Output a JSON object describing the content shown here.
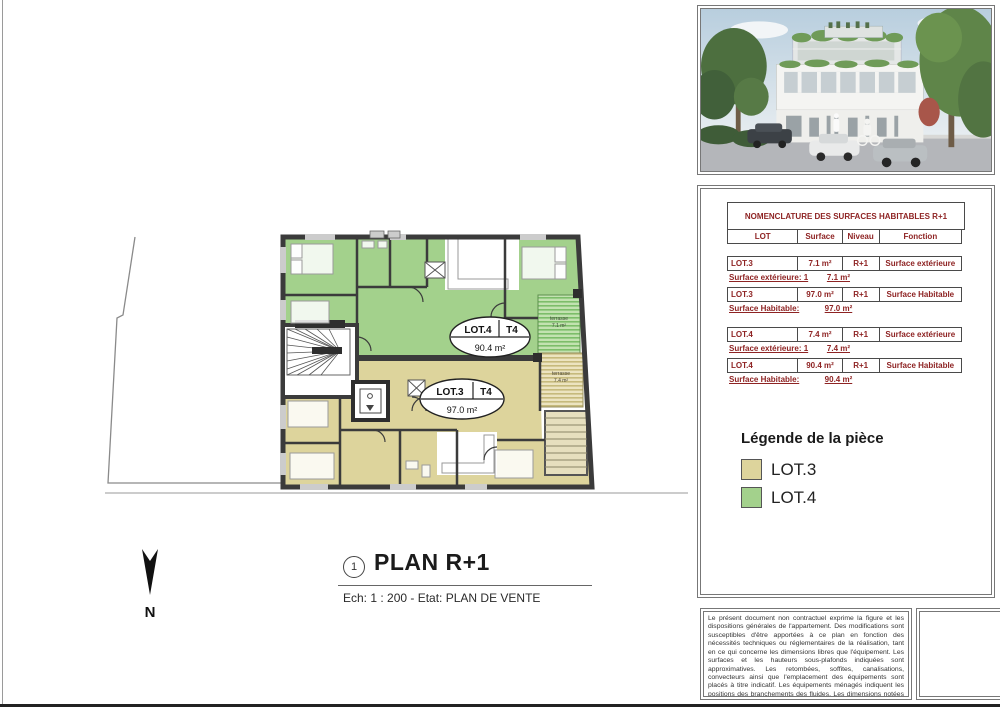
{
  "plan": {
    "number": "1",
    "title": "PLAN R+1",
    "scale_state": "Ech: 1 : 200 - Etat: PLAN DE VENTE",
    "north": "N",
    "badges": {
      "lot4": {
        "lot": "LOT.4",
        "type": "T4",
        "area": "90.4 m²"
      },
      "lot3": {
        "lot": "LOT.3",
        "type": "T4",
        "area": "97.0 m²"
      }
    },
    "terraces": {
      "green": {
        "label": "terrasse",
        "area": "7.1 m²"
      },
      "tan": {
        "label": "terrasse",
        "area": "7.4 m²"
      }
    },
    "colors": {
      "lot3_fill": "#ddd49c",
      "lot4_fill": "#a3d18c",
      "wall": "#3b3b3b"
    }
  },
  "nomenclature": {
    "title": "NOMENCLATURE DES SURFACES HABITABLES R+1",
    "text_color": "#8e2323",
    "headers": {
      "lot": "LOT",
      "surface": "Surface",
      "niveau": "Niveau",
      "fonction": "Fonction"
    },
    "groups": [
      {
        "rows": [
          {
            "lot": "LOT.3",
            "surface": "7.1 m²",
            "niveau": "R+1",
            "fonction": "Surface extérieure",
            "sub_label": "Surface extérieure: 1",
            "sub_value": "7.1 m²"
          },
          {
            "lot": "LOT.3",
            "surface": "97.0 m²",
            "niveau": "R+1",
            "fonction": "Surface Habitable",
            "sub_label": "Surface Habitable:",
            "sub_value": "97.0 m²"
          }
        ]
      },
      {
        "rows": [
          {
            "lot": "LOT.4",
            "surface": "7.4 m²",
            "niveau": "R+1",
            "fonction": "Surface extérieure",
            "sub_label": "Surface extérieure: 1",
            "sub_value": "7.4 m²"
          },
          {
            "lot": "LOT.4",
            "surface": "90.4 m²",
            "niveau": "R+1",
            "fonction": "Surface Habitable",
            "sub_label": "Surface Habitable:",
            "sub_value": "90.4 m²"
          }
        ]
      }
    ]
  },
  "legend": {
    "title": "Légende de la pièce",
    "items": [
      {
        "label": "LOT.3",
        "color": "#ddd49c"
      },
      {
        "label": "LOT.4",
        "color": "#a3d18c"
      }
    ]
  },
  "notes": {
    "disclaimer": "Le présent document non contractuel exprime la figure et les dispositions générales de l'appartement. Des modifications sont susceptibles d'être apportées à ce plan en fonction des nécessités techniques ou réglementaires de la réalisation, tant en ce qui concerne les dimensions libres que l'équipement. Les surfaces et les hauteurs sous-plafonds indiquées sont approximatives. Les retombées, soffites, canalisations, convecteurs ainsi que l'emplacement des équipements sont placés à titre indicatif. Les équipements ménagés indiquent les positions des branchements des fluides. Les dimensions notées sont les dimensions principales des pièces, hors décrochements, baies et surfaces inférieures à 1.80m."
  }
}
